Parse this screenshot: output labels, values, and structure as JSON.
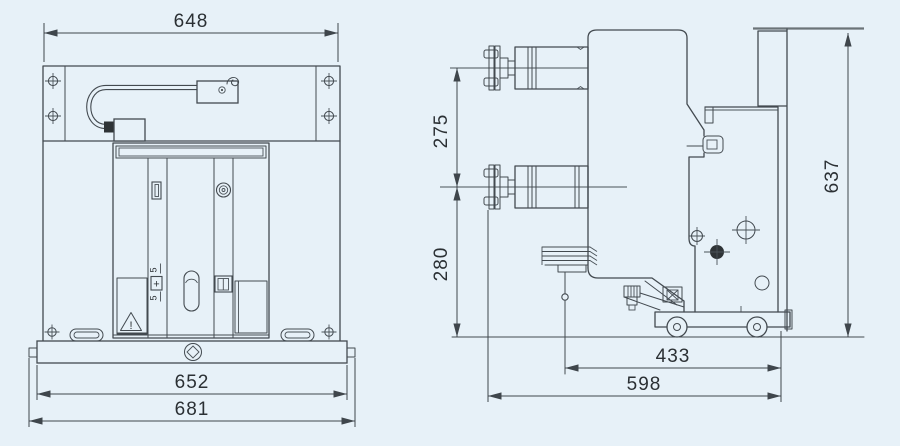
{
  "colors": {
    "background": "#e7f1f8",
    "line": "#434a50",
    "text": "#2b3034"
  },
  "front_view": {
    "dim_top_width": "648",
    "dim_base_width": "652",
    "dim_overall_width": "681",
    "counter": {
      "upper_digit": "5",
      "plus": "+",
      "lower_digit": "5"
    },
    "warning_mark": "!"
  },
  "side_view": {
    "dim_pole_centers": "275",
    "dim_lower_terminal_height": "280",
    "dim_overall_height": "637",
    "dim_wheelbase": "433",
    "dim_overall_depth": "598"
  }
}
